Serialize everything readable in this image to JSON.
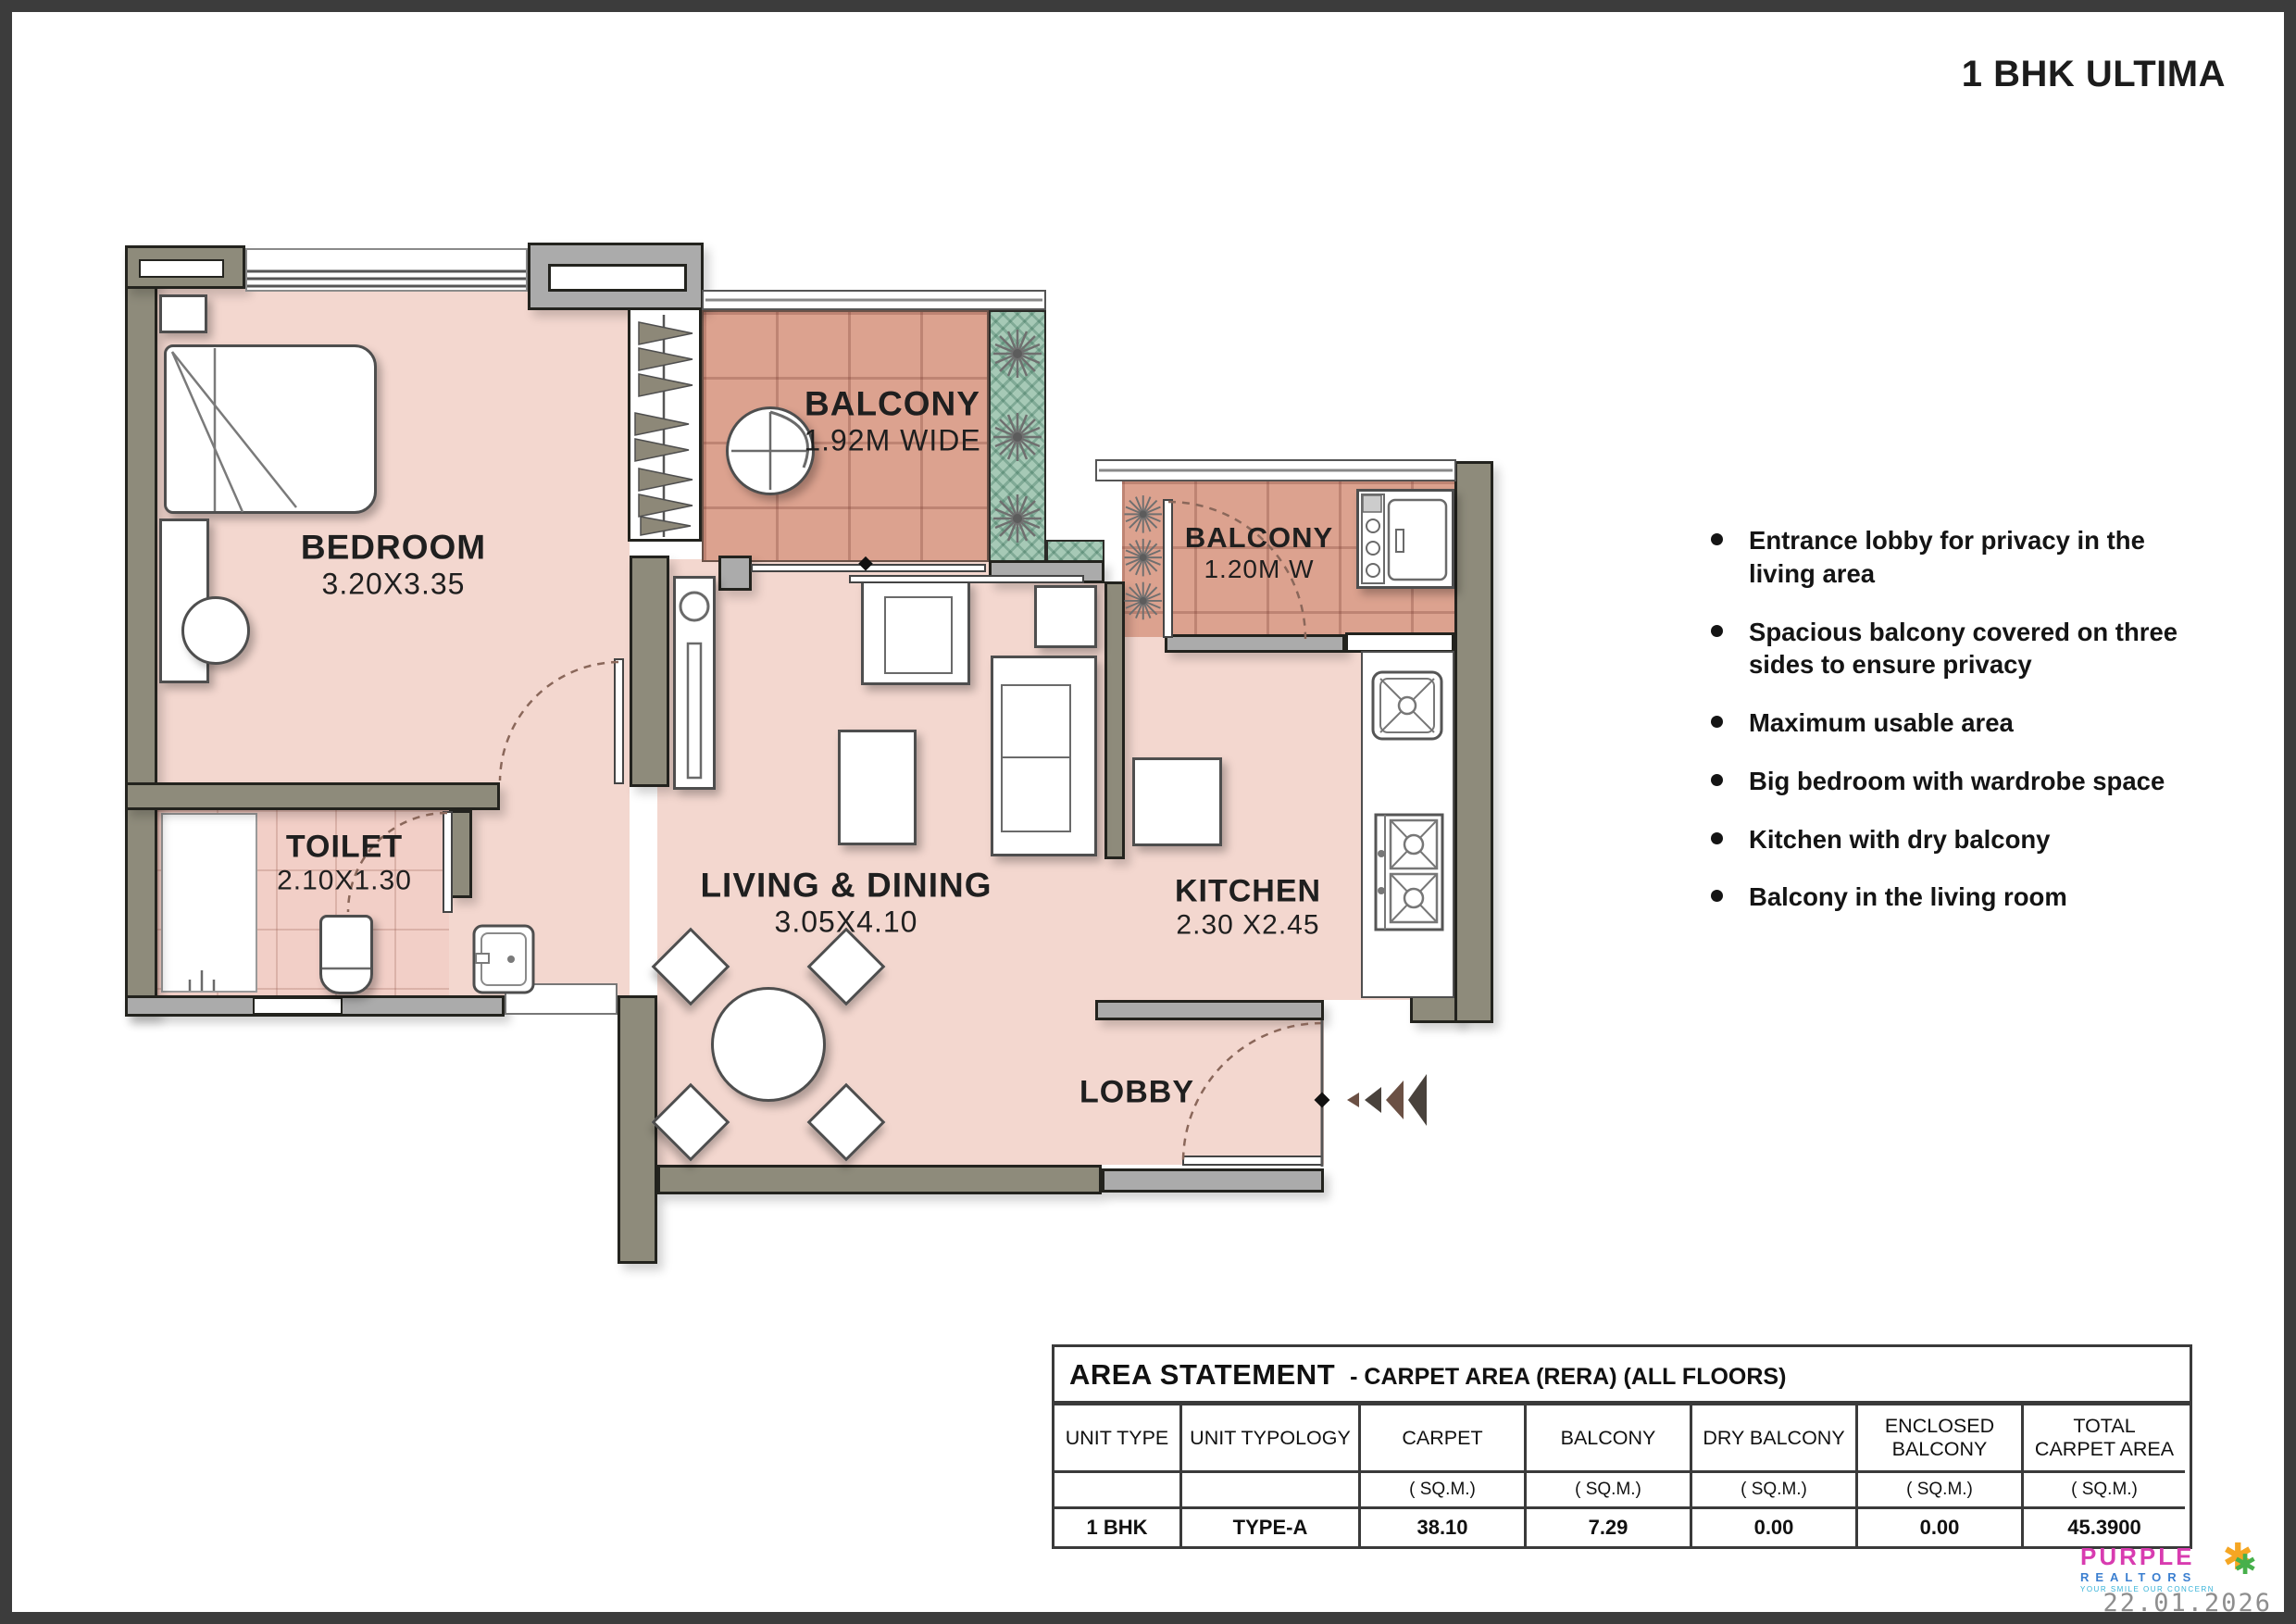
{
  "page": {
    "title": "1 BHK ULTIMA",
    "date": "22.01.2026"
  },
  "plan": {
    "rooms": {
      "bedroom": {
        "name": "BEDROOM",
        "dim": "3.20X3.35"
      },
      "toilet": {
        "name": "TOILET",
        "dim": "2.10X1.30"
      },
      "balcony_main": {
        "name": "BALCONY",
        "dim": "1.92M WIDE"
      },
      "balcony_dry": {
        "name": "BALCONY",
        "dim": "1.20M W"
      },
      "living": {
        "name": "LIVING & DINING",
        "dim": "3.05X4.10"
      },
      "kitchen": {
        "name": "KITCHEN",
        "dim": "2.30 X2.45"
      },
      "lobby": {
        "name": "LOBBY"
      }
    }
  },
  "features": {
    "items": [
      "Entrance lobby for privacy in the living area",
      "Spacious balcony covered on three sides to ensure privacy",
      "Maximum usable area",
      "Big bedroom with wardrobe space",
      "Kitchen with dry balcony",
      "Balcony in the living room"
    ]
  },
  "area_table": {
    "title": "AREA STATEMENT",
    "subtitle": "- CARPET AREA (RERA) (ALL FLOORS)",
    "columns": [
      "UNIT TYPE",
      "UNIT TYPOLOGY",
      "CARPET",
      "BALCONY",
      "DRY BALCONY",
      "ENCLOSED BALCONY",
      "TOTAL CARPET AREA"
    ],
    "units": [
      "",
      "",
      "( SQ.M.)",
      "( SQ.M.)",
      "( SQ.M.)",
      "( SQ.M.)",
      "( SQ.M.)"
    ],
    "row": [
      "1 BHK",
      "TYPE-A",
      "38.10",
      "7.29",
      "0.00",
      "0.00",
      "45.3900"
    ]
  },
  "logo": {
    "line1": "PURPLE",
    "line2": "REALTORS",
    "tagline": "YOUR SMILE OUR CONCERN"
  },
  "colors": {
    "floor": "#f3d7cf",
    "balcony_tile": "#dca28f",
    "wall": "#8e8b7b",
    "planter": "#a6c9b6"
  }
}
